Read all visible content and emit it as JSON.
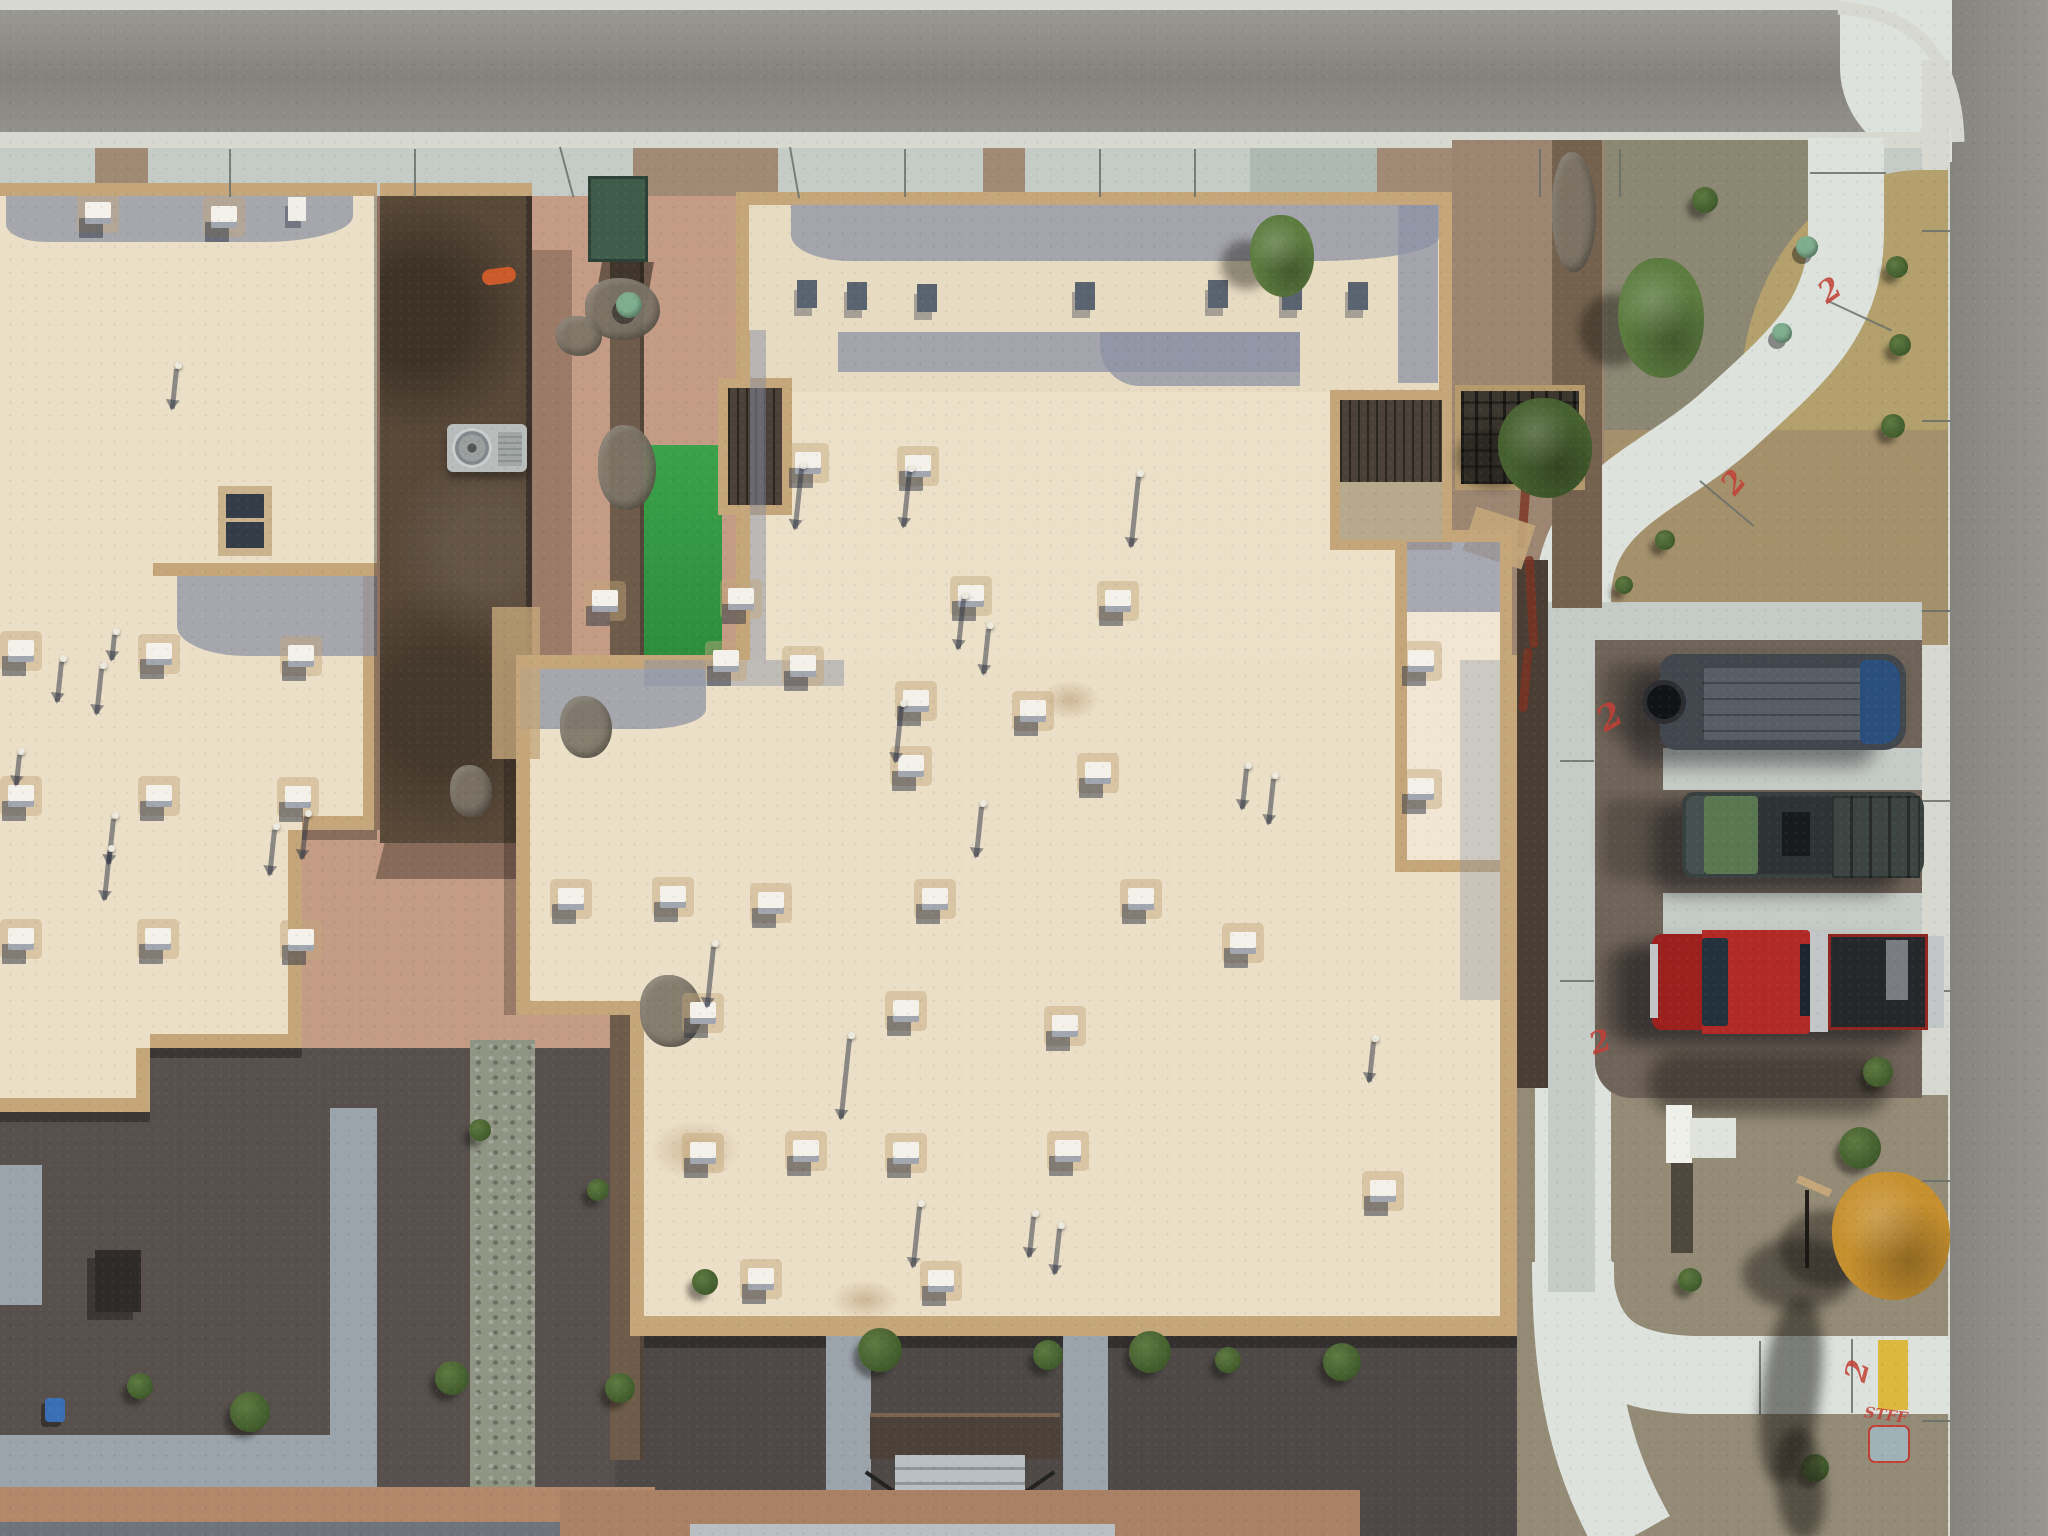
{
  "meta": {
    "title": "Aerial drone photograph — flat-roof townhomes, desert landscaping, street parking",
    "view": "top-down nadir view, sun from upper right casting shadows down-left"
  },
  "palette": {
    "road": "#8e8c85",
    "road2": "#918f88",
    "curb": "#d7d8d0",
    "walk": "#c5cbc6",
    "walk_bright": "#dde2dc",
    "walk_teal": "#aeb9b1",
    "gravel_top": "#a08a76",
    "gravel_gray": "#8b8773",
    "gravel_mid": "#a5906c",
    "gravel_mid2": "#9c8672",
    "gravel_bot": "#948b77",
    "grass_dry": "#b3a06c",
    "dirt": "#c49c85",
    "court_dark": "#57504d",
    "court_dark2": "#4e4947",
    "brick": "#b3886a",
    "brick2": "#aa8164",
    "paver": "#9ba3ab",
    "paver_light": "#b9bec2",
    "paver_dark": "#6d747c",
    "riprap": "#8f9483",
    "turf": "#2e8f3e",
    "turf2": "#27843a",
    "cream": "#ebdfc7",
    "cream2": "#ece0c9",
    "cream3": "#e7dbc2",
    "cream4": "#f0e6d3",
    "parapet": "#c4a67a",
    "parapet2": "#b59a6e",
    "roofshadow": "#8a90a4",
    "deck": "#4b4138",
    "deck2": "#3b372f",
    "brownroof": "#584838",
    "fence": "#6e5b49",
    "fence_dark": "#4a3e34",
    "wall": "#75624e",
    "asphalt": "#6f6459",
    "ac": "#b8bcbb",
    "utilgreen": "#3f5c4a",
    "dome": "#7fae8e",
    "orange": "#cc5a2a",
    "tree_green": "#5d7c40",
    "tree_dark": "#46602f",
    "tree_yellow": "#c6902f",
    "van_body": "#42464d",
    "van_roof": "#595e66",
    "van_glass": "#2b4f7d",
    "truck_body": "#394140",
    "truck_glass": "#5d7a52",
    "truck_roof": "#2e3434",
    "red_truck": "#b12a26",
    "red_dark": "#9c211e",
    "bed_dark": "#25272b",
    "silver": "#c3c6c7",
    "yellow_curb": "#ddb83e",
    "spray_red": "#c23f35"
  },
  "objects": {
    "vehicles": [
      {
        "label": "dark gray cargo van with spare tire",
        "palette_key": "van_body"
      },
      {
        "label": "dark pickup truck with sunroof and ribbed bed cover",
        "palette_key": "truck_body"
      },
      {
        "label": "red pickup truck with open bed",
        "palette_key": "red_truck"
      }
    ],
    "buildings": [
      "left townhome flat roof with brown two-story wing",
      "large central townhome flat roof with stepped parapets"
    ],
    "landscape": [
      "desert gravel",
      "artificial turf strips",
      "riprap rock drainage",
      "curved concrete sidewalk",
      "street parking stalls"
    ]
  },
  "scene": {
    "spray_marks": [
      {
        "text": "2",
        "x": 1598,
        "y": 700,
        "rot": -30,
        "size": 34
      },
      {
        "text": "2",
        "x": 1590,
        "y": 1028,
        "rot": -20,
        "size": 30
      },
      {
        "text": "2",
        "x": 1820,
        "y": 276,
        "rot": -35,
        "size": 30
      },
      {
        "text": "2",
        "x": 1724,
        "y": 468,
        "rot": -50,
        "size": 30
      },
      {
        "text": "2",
        "x": 1848,
        "y": 1356,
        "rot": -75,
        "size": 30
      },
      {
        "text": "STFF",
        "x": 1864,
        "y": 1408,
        "rot": 8,
        "size": 15
      }
    ],
    "utility_pad": {
      "x": 1868,
      "y": 1425,
      "w": 38,
      "h": 34,
      "color": "#9fb3b6"
    },
    "vents_white": [
      [
        795,
        452
      ],
      [
        905,
        455
      ],
      [
        592,
        590
      ],
      [
        728,
        588
      ],
      [
        958,
        585
      ],
      [
        1105,
        590
      ],
      [
        713,
        650
      ],
      [
        790,
        655
      ],
      [
        903,
        690
      ],
      [
        1020,
        700
      ],
      [
        898,
        755
      ],
      [
        1085,
        762
      ],
      [
        1408,
        650
      ],
      [
        1408,
        778
      ],
      [
        558,
        888
      ],
      [
        660,
        886
      ],
      [
        758,
        892
      ],
      [
        922,
        888
      ],
      [
        1128,
        888
      ],
      [
        1230,
        932
      ],
      [
        690,
        1002
      ],
      [
        893,
        1000
      ],
      [
        1052,
        1015
      ],
      [
        690,
        1142
      ],
      [
        793,
        1140
      ],
      [
        893,
        1142
      ],
      [
        1055,
        1140
      ],
      [
        748,
        1268
      ],
      [
        928,
        1270
      ],
      [
        1370,
        1180
      ]
    ],
    "pipes_main": [
      [
        800,
        462,
        60
      ],
      [
        908,
        465,
        55
      ],
      [
        962,
        592,
        50
      ],
      [
        987,
        622,
        45
      ],
      [
        900,
        700,
        55
      ],
      [
        712,
        940,
        60
      ],
      [
        980,
        800,
        50
      ],
      [
        1245,
        762,
        40
      ],
      [
        1272,
        772,
        45
      ],
      [
        848,
        1032,
        80
      ],
      [
        918,
        1200,
        60
      ],
      [
        1032,
        1210,
        40
      ],
      [
        1058,
        1222,
        45
      ],
      [
        1137,
        470,
        70
      ],
      [
        1372,
        1035,
        40
      ]
    ],
    "vents_dark": [
      [
        797,
        280
      ],
      [
        847,
        282
      ],
      [
        917,
        284
      ],
      [
        1075,
        282
      ],
      [
        1208,
        280
      ],
      [
        1282,
        282
      ],
      [
        1348,
        282
      ]
    ],
    "vents_left": [
      [
        8,
        640
      ],
      [
        146,
        643
      ],
      [
        288,
        645
      ],
      [
        8,
        785
      ],
      [
        146,
        785
      ],
      [
        285,
        786
      ],
      [
        8,
        928
      ],
      [
        145,
        928
      ],
      [
        288,
        929
      ],
      [
        85,
        202
      ],
      [
        211,
        206
      ]
    ],
    "pipes_left": [
      [
        60,
        655,
        40
      ],
      [
        100,
        662,
        45
      ],
      [
        18,
        748,
        30
      ],
      [
        112,
        812,
        45
      ],
      [
        108,
        845,
        48
      ],
      [
        273,
        823,
        45
      ],
      [
        305,
        810,
        42
      ],
      [
        113,
        628,
        25
      ],
      [
        175,
        362,
        40
      ]
    ],
    "shrubs": [
      [
        250,
        1412,
        40
      ],
      [
        140,
        1386,
        26
      ],
      [
        452,
        1378,
        34
      ],
      [
        620,
        1388,
        30
      ],
      [
        880,
        1350,
        44
      ],
      [
        1150,
        1352,
        42
      ],
      [
        1342,
        1362,
        38
      ],
      [
        705,
        1282,
        26
      ],
      [
        1878,
        1072,
        30
      ],
      [
        1860,
        1148,
        42
      ],
      [
        1690,
        1280,
        24
      ],
      [
        1815,
        1468,
        28
      ],
      [
        1900,
        345,
        22
      ],
      [
        1893,
        426,
        24
      ],
      [
        1897,
        267,
        22
      ],
      [
        1705,
        200,
        26
      ],
      [
        1048,
        1355,
        30
      ],
      [
        1228,
        1360,
        26
      ],
      [
        598,
        1190,
        22
      ],
      [
        480,
        1130,
        22
      ],
      [
        1665,
        540,
        20
      ],
      [
        1624,
        585,
        18
      ]
    ],
    "rocks": [
      [
        585,
        278,
        75,
        62
      ],
      [
        598,
        425,
        58,
        85
      ],
      [
        560,
        696,
        52,
        62
      ],
      [
        640,
        975,
        62,
        72
      ],
      [
        450,
        765,
        42,
        52
      ],
      [
        556,
        316,
        46,
        40
      ],
      [
        1552,
        152,
        44,
        120
      ]
    ],
    "trees": [
      {
        "x": 1618,
        "y": 258,
        "w": 86,
        "h": 120,
        "color": "tree_green"
      },
      {
        "x": 1250,
        "y": 215,
        "w": 64,
        "h": 82,
        "color": "tree_green"
      },
      {
        "x": 1498,
        "y": 398,
        "w": 94,
        "h": 100,
        "color": "tree_dark"
      },
      {
        "x": 1832,
        "y": 1172,
        "w": 118,
        "h": 128,
        "color": "tree_yellow"
      }
    ],
    "domes": [
      [
        616,
        292,
        26
      ],
      [
        1796,
        236,
        22
      ],
      [
        1772,
        323,
        20
      ]
    ],
    "joints": [
      [
        230,
        148,
        48,
        90
      ],
      [
        415,
        148,
        48,
        90
      ],
      [
        905,
        148,
        48,
        90
      ],
      [
        1100,
        148,
        48,
        90
      ],
      [
        1195,
        148,
        48,
        90
      ],
      [
        1540,
        148,
        48,
        90
      ],
      [
        1620,
        148,
        48,
        90
      ],
      [
        560,
        146,
        52,
        75
      ],
      [
        790,
        146,
        52,
        80
      ],
      [
        1922,
        230,
        28,
        0
      ],
      [
        1922,
        420,
        28,
        0
      ],
      [
        1922,
        610,
        28,
        0
      ],
      [
        1922,
        800,
        28,
        0
      ],
      [
        1922,
        990,
        28,
        0
      ],
      [
        1922,
        1180,
        28,
        0
      ],
      [
        1922,
        1420,
        28,
        0
      ],
      [
        1760,
        1340,
        74,
        90
      ],
      [
        1852,
        1338,
        74,
        90
      ],
      [
        1810,
        172,
        76,
        0
      ],
      [
        1828,
        300,
        70,
        25
      ],
      [
        1700,
        480,
        70,
        40
      ],
      [
        1560,
        760,
        34,
        0
      ],
      [
        1560,
        980,
        34,
        0
      ]
    ]
  }
}
